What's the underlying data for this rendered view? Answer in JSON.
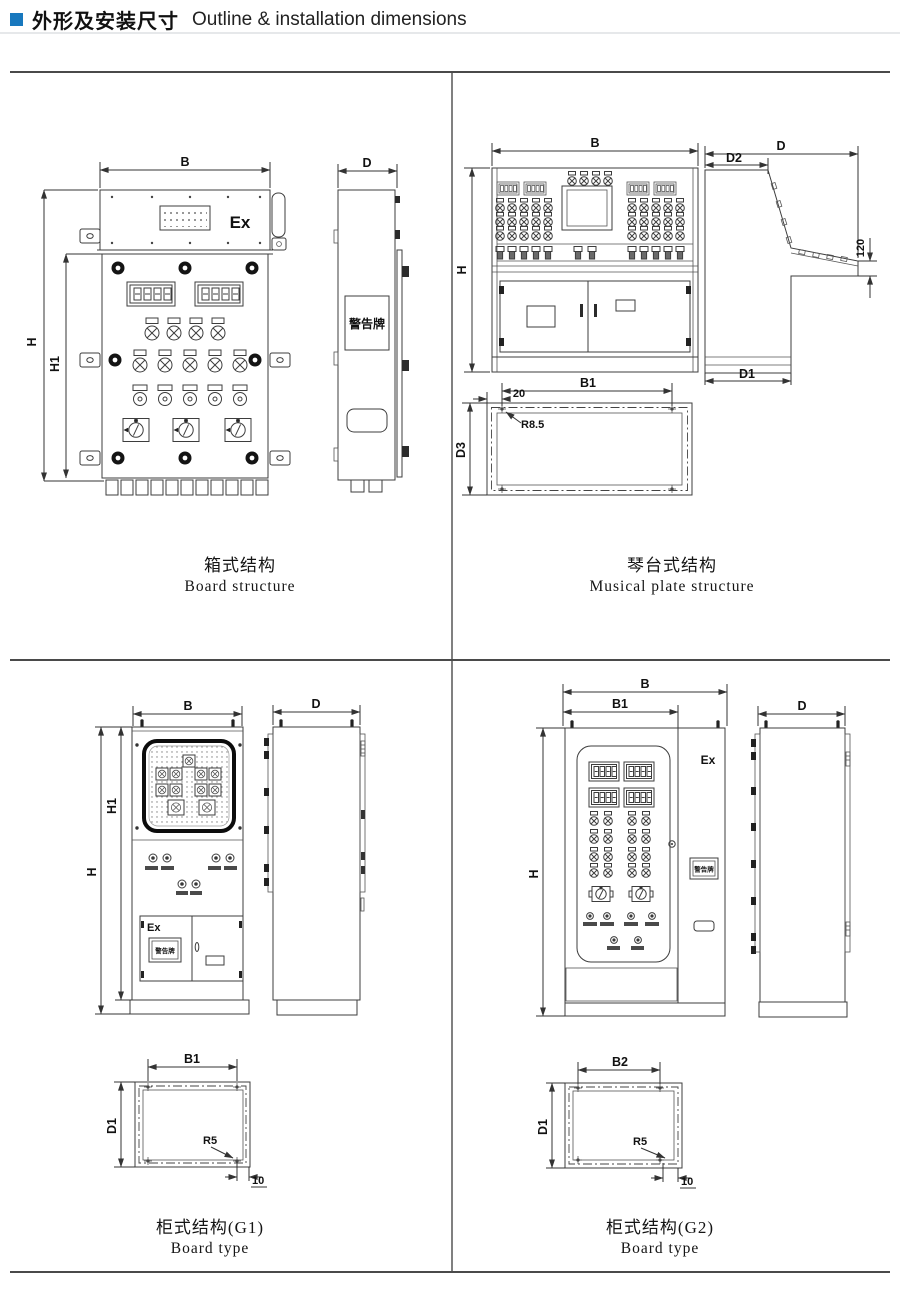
{
  "header": {
    "bullet_color": "#1878be",
    "title_zh": "外形及安装尺寸",
    "title_en": "Outline & installation dimensions"
  },
  "panels": {
    "box": {
      "caption_zh": "箱式结构",
      "caption_en": "Board structure",
      "front": {
        "dim_width": "B",
        "dim_height": "H",
        "dim_height1": "H1",
        "marking": "Ex"
      },
      "side": {
        "dim_depth": "D",
        "warning_plate": "警告牌"
      }
    },
    "console": {
      "caption_zh": "琴台式结构",
      "caption_en": "Musical plate structure",
      "front": {
        "dim_width": "B",
        "dim_height": "H"
      },
      "side": {
        "dim_depth": "D",
        "dim_top_depth": "D2",
        "dim_drop": "120",
        "dim_base_depth": "D1"
      },
      "plan": {
        "dim_hole_span": "B1",
        "dim_offset": "20",
        "corner_radius": "R8.5",
        "dim_depth": "D3"
      }
    },
    "g1": {
      "caption_zh": "柜式结构(G1)",
      "caption_en": "Board type",
      "front": {
        "dim_width": "B",
        "dim_height": "H",
        "dim_height1": "H1",
        "marking": "Ex",
        "warning_plate": "警告牌"
      },
      "side": {
        "dim_depth": "D"
      },
      "plan": {
        "dim_hole_span": "B1",
        "dim_depth": "D1",
        "corner_radius": "R5",
        "dim_offset": "10"
      }
    },
    "g2": {
      "caption_zh": "柜式结构(G2)",
      "caption_en": "Board type",
      "front": {
        "dim_width": "B",
        "dim_width1": "B1",
        "dim_height": "H",
        "marking": "Ex",
        "warning_plate": "警告牌"
      },
      "side": {
        "dim_depth": "D"
      },
      "plan": {
        "dim_hole_span": "B2",
        "dim_depth": "D1",
        "corner_radius": "R5",
        "dim_offset": "10"
      }
    }
  }
}
